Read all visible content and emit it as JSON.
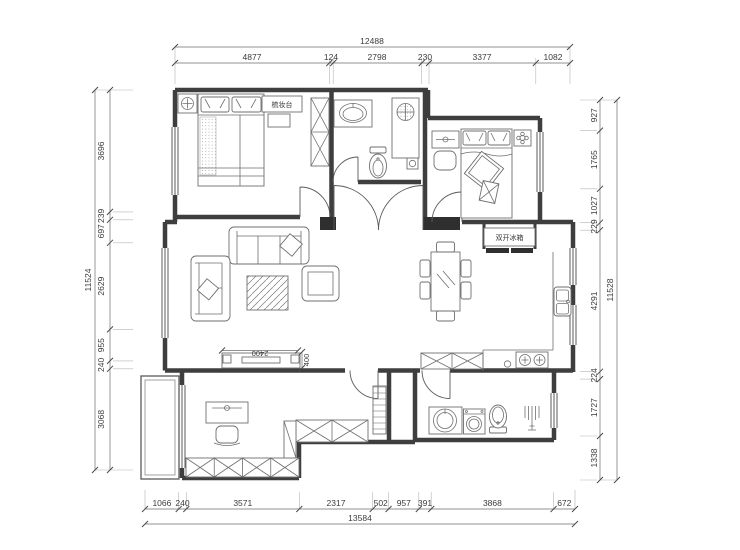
{
  "dims": {
    "top": {
      "overall": "12488",
      "segments": [
        "4877",
        "124",
        "2798",
        "230",
        "3377",
        "1082"
      ]
    },
    "bottom": {
      "overall": "13584",
      "segments": [
        "1066",
        "240",
        "3571",
        "2317",
        "502",
        "957",
        "391",
        "3868",
        "672"
      ]
    },
    "left": {
      "overall": "11524",
      "segments": [
        "3696",
        "239",
        "697",
        "2629",
        "955",
        "240",
        "3068"
      ]
    },
    "right": {
      "overall": "11528",
      "segments": [
        "927",
        "1765",
        "1027",
        "229",
        "4291",
        "224",
        "1727",
        "1338"
      ]
    }
  },
  "labels": {
    "dressing_table": "梳妆台",
    "fridge": "双开冰箱",
    "tv_width": "2400",
    "tv_depth": "400"
  },
  "colors": {
    "line": "#3e3e3e",
    "dim_text": "#3c3c3c",
    "background": "#ffffff"
  }
}
